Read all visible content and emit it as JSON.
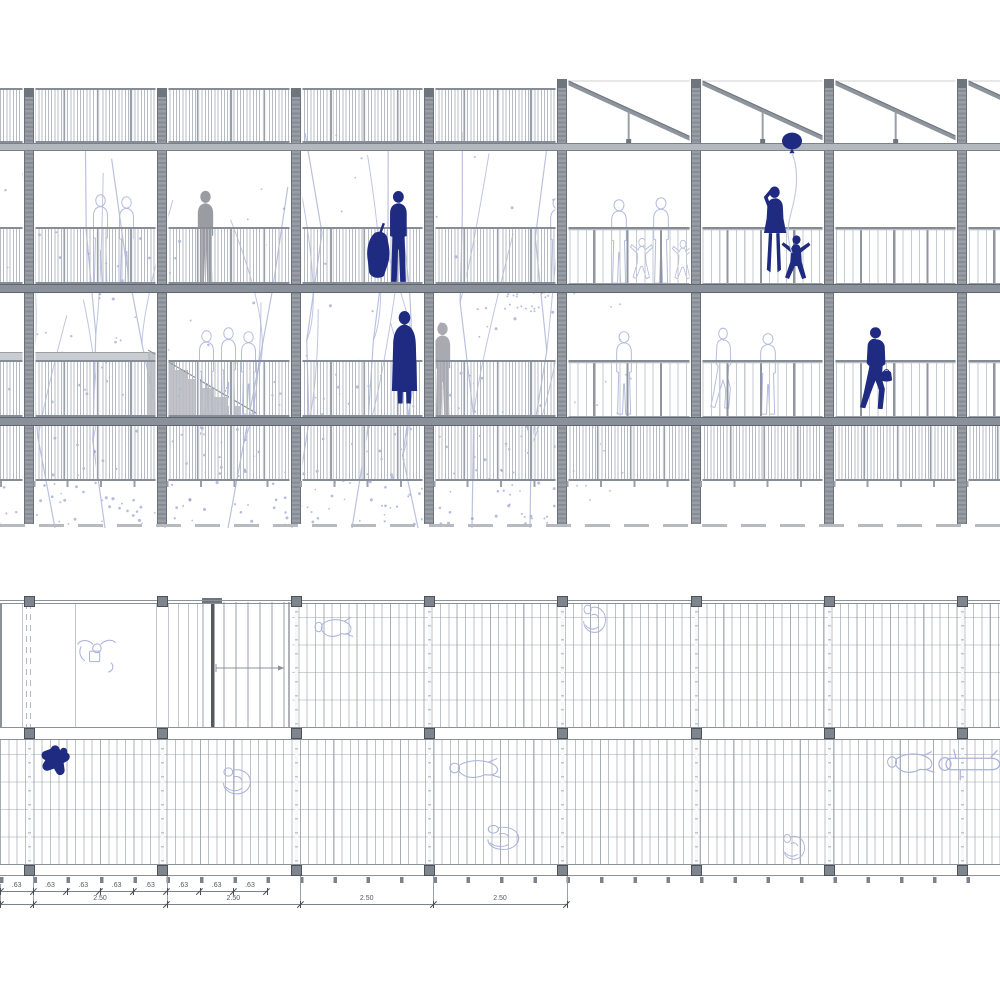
{
  "drawing": {
    "kind": "architectural drawing",
    "views": [
      "building longitudinal elevation-section",
      "deck floor plan"
    ]
  },
  "colors": {
    "navy": "#1f2b80",
    "gray_figure": "#9b9ca1",
    "gray_figure_light": "#a9aab0",
    "outline_figure": "#b3bbdf",
    "plan_outline_figure": "#a9b2d8",
    "structure": "#8b9199",
    "structure_dark": "#6f757d",
    "tree": "#a9b2d8",
    "tree_dot": "#95a0ce",
    "balloon_string": "#c6cce0",
    "stair_gray": "#b6b9be",
    "dim_text": "#555a60"
  },
  "grid": {
    "column_centers_x": [
      29,
      162,
      296,
      429,
      562,
      696,
      829,
      962
    ],
    "bay_width": 133.33,
    "module": 33.33
  },
  "elevation": {
    "levels": {
      "parapet_band": [
        88,
        143
      ],
      "roof_beam": [
        143,
        149
      ],
      "level3_rail_band": [
        227,
        284
      ],
      "level3_floor_slab": [
        284,
        291
      ],
      "level2_rail_band": [
        360,
        417
      ],
      "level2_floor_slab": [
        417,
        424
      ],
      "lower_screen_band": [
        424,
        481
      ],
      "under_posts_y": 481,
      "ground_line_y": 524
    },
    "sawtooth": {
      "start_x": 557,
      "teeth_x": [
        562,
        696,
        829,
        962
      ],
      "peak_y": 80,
      "eave_y": 143
    },
    "hatched_extent_x": [
      0,
      562
    ],
    "open_rail_extent_x": [
      562,
      1000
    ],
    "landing_strip": {
      "x": 0,
      "y": 352,
      "w": 150,
      "h": 8
    },
    "stair": {
      "x": 148,
      "y": 350,
      "w": 112,
      "h": 68
    },
    "figures": [
      {
        "type": "stand",
        "x": 194,
        "y": 190,
        "w": 23,
        "h": 94,
        "render": "fill",
        "color_key": "gray_figure",
        "name": "gray-person-level3"
      },
      {
        "type": "stand",
        "x": 431,
        "y": 322,
        "w": 23,
        "h": 95,
        "render": "fill",
        "color_key": "gray_figure_light",
        "name": "gray-person-level2"
      },
      {
        "type": "stand",
        "x": 90,
        "y": 194,
        "w": 21,
        "h": 90,
        "render": "outline",
        "color_key": "outline_figure",
        "name": "outline-person"
      },
      {
        "type": "stand",
        "x": 116,
        "y": 196,
        "w": 21,
        "h": 88,
        "render": "outline",
        "color_key": "outline_figure",
        "name": "outline-person"
      },
      {
        "type": "stand",
        "x": 196,
        "y": 330,
        "w": 21,
        "h": 85,
        "render": "outline",
        "color_key": "outline_figure",
        "name": "outline-person"
      },
      {
        "type": "stand",
        "x": 218,
        "y": 327,
        "w": 21,
        "h": 88,
        "render": "outline",
        "color_key": "outline_figure",
        "name": "outline-person"
      },
      {
        "type": "stand",
        "x": 238,
        "y": 331,
        "w": 21,
        "h": 84,
        "render": "outline",
        "color_key": "outline_figure",
        "name": "outline-person"
      },
      {
        "type": "stand",
        "x": 547,
        "y": 197,
        "w": 22,
        "h": 87,
        "render": "outline",
        "color_key": "outline_figure",
        "name": "outline-person"
      },
      {
        "type": "stand",
        "x": 608,
        "y": 199,
        "w": 22,
        "h": 85,
        "render": "outline",
        "color_key": "outline_figure",
        "name": "outline-person"
      },
      {
        "type": "childArms",
        "x": 630,
        "y": 238,
        "w": 24,
        "h": 46,
        "render": "outline",
        "color_key": "outline_figure",
        "name": "outline-child"
      },
      {
        "type": "stand",
        "x": 650,
        "y": 197,
        "w": 22,
        "h": 87,
        "render": "outline",
        "color_key": "outline_figure",
        "name": "outline-person"
      },
      {
        "type": "childArms",
        "x": 672,
        "y": 240,
        "w": 22,
        "h": 44,
        "render": "outline",
        "color_key": "outline_figure",
        "name": "outline-child"
      },
      {
        "type": "stand",
        "x": 613,
        "y": 331,
        "w": 22,
        "h": 84,
        "render": "outline",
        "color_key": "outline_figure",
        "name": "outline-person"
      },
      {
        "type": "walk",
        "x": 710,
        "y": 328,
        "w": 26,
        "h": 86,
        "render": "outline",
        "color_key": "outline_figure",
        "name": "outline-person-hat"
      },
      {
        "type": "stand",
        "x": 757,
        "y": 333,
        "w": 22,
        "h": 82,
        "render": "outline",
        "color_key": "outline_figure",
        "name": "outline-person"
      },
      {
        "type": "cellist",
        "x": 364,
        "y": 190,
        "w": 50,
        "h": 94,
        "render": "fill",
        "color_key": "navy",
        "name": "navy-cellist"
      },
      {
        "type": "balloonWoman",
        "x": 757,
        "y": 182,
        "w": 31,
        "h": 102,
        "render": "fill",
        "color_key": "navy",
        "name": "navy-woman-waving"
      },
      {
        "type": "childArms",
        "x": 781,
        "y": 235,
        "w": 31,
        "h": 50,
        "render": "fill",
        "color_key": "navy",
        "name": "navy-child"
      },
      {
        "type": "balloon",
        "x": 780,
        "y": 132,
        "w": 24,
        "h": 125,
        "render": "fill",
        "color_key": "navy",
        "name": "balloon"
      },
      {
        "type": "coat",
        "x": 389,
        "y": 310,
        "w": 31,
        "h": 108,
        "render": "fill",
        "color_key": "navy",
        "name": "navy-coat-person"
      },
      {
        "type": "walk",
        "x": 859,
        "y": 327,
        "w": 33,
        "h": 88,
        "render": "fill",
        "color_key": "navy",
        "name": "navy-walking-woman"
      },
      {
        "type": "bag",
        "x": 880,
        "y": 366,
        "w": 13,
        "h": 17,
        "render": "fill",
        "color_key": "navy",
        "name": "navy-bag"
      }
    ]
  },
  "plan": {
    "top_edge_y": 600,
    "room": {
      "x0": 0,
      "x1": 290,
      "y0": 603,
      "y1": 727
    },
    "upper_deck": {
      "x0": 290,
      "x1": 1000,
      "y0": 603,
      "y1": 727
    },
    "middle_band_y": [
      727,
      740
    ],
    "lower_deck": {
      "x0": 0,
      "x1": 1000,
      "y0": 740,
      "y1": 864
    },
    "bottom_edge_y": [
      864,
      876
    ],
    "stair": {
      "x": 200,
      "y": 598,
      "w": 92,
      "h": 142
    },
    "figures": [
      {
        "type": "planSitTable",
        "x": 70,
        "y": 634,
        "w": 52,
        "h": 40,
        "render": "outline",
        "color_key": "plan_outline_figure",
        "name": "plan-person-at-table"
      },
      {
        "type": "planLying",
        "x": 312,
        "y": 606,
        "w": 44,
        "h": 42,
        "render": "outline",
        "color_key": "plan_outline_figure",
        "name": "plan-person-lying"
      },
      {
        "type": "planCurl",
        "x": 576,
        "y": 599,
        "w": 34,
        "h": 42,
        "render": "outline",
        "color_key": "plan_outline_figure",
        "name": "plan-person"
      },
      {
        "type": "planLying",
        "x": 446,
        "y": 747,
        "w": 58,
        "h": 42,
        "render": "outline",
        "color_key": "plan_outline_figure",
        "name": "plan-person-lying"
      },
      {
        "type": "planCurl",
        "x": 477,
        "y": 820,
        "w": 48,
        "h": 37,
        "render": "outline",
        "color_key": "plan_outline_figure",
        "name": "plan-person"
      },
      {
        "type": "planCurl",
        "x": 776,
        "y": 829,
        "w": 33,
        "h": 38,
        "render": "outline",
        "color_key": "plan_outline_figure",
        "name": "plan-person"
      },
      {
        "type": "planCurl",
        "x": 214,
        "y": 762,
        "w": 42,
        "h": 40,
        "render": "outline",
        "color_key": "plan_outline_figure",
        "name": "plan-person"
      },
      {
        "type": "planLying",
        "x": 884,
        "y": 739,
        "w": 54,
        "h": 46,
        "render": "outline",
        "color_key": "plan_outline_figure",
        "name": "plan-sunbather"
      },
      {
        "type": "planLying2",
        "x": 934,
        "y": 741,
        "w": 70,
        "h": 46,
        "render": "outline",
        "color_key": "plan_outline_figure",
        "name": "plan-sunbather"
      },
      {
        "type": "planNavy",
        "x": 38,
        "y": 744,
        "w": 33,
        "h": 36,
        "render": "fill",
        "color_key": "navy",
        "name": "plan-navy-person"
      }
    ]
  },
  "dimensions": {
    "small_row": {
      "labels": [
        ".63",
        ".63",
        ".63",
        ".63",
        ".63",
        ".63",
        ".63",
        ".63"
      ],
      "start_x": 0,
      "step": 33.33,
      "line_y": 891
    },
    "large_row": {
      "labels": [
        "2.50",
        "2.50",
        "2.50",
        "2.50"
      ],
      "ticks_x": [
        0,
        33.3,
        166.7,
        300,
        433.3,
        566.7
      ],
      "centers_x": [
        100,
        233.3,
        366.7,
        500
      ],
      "line_y": 904
    },
    "extension_lines_x": [
      33.3,
      166.7,
      300,
      433.3,
      566.7
    ]
  }
}
